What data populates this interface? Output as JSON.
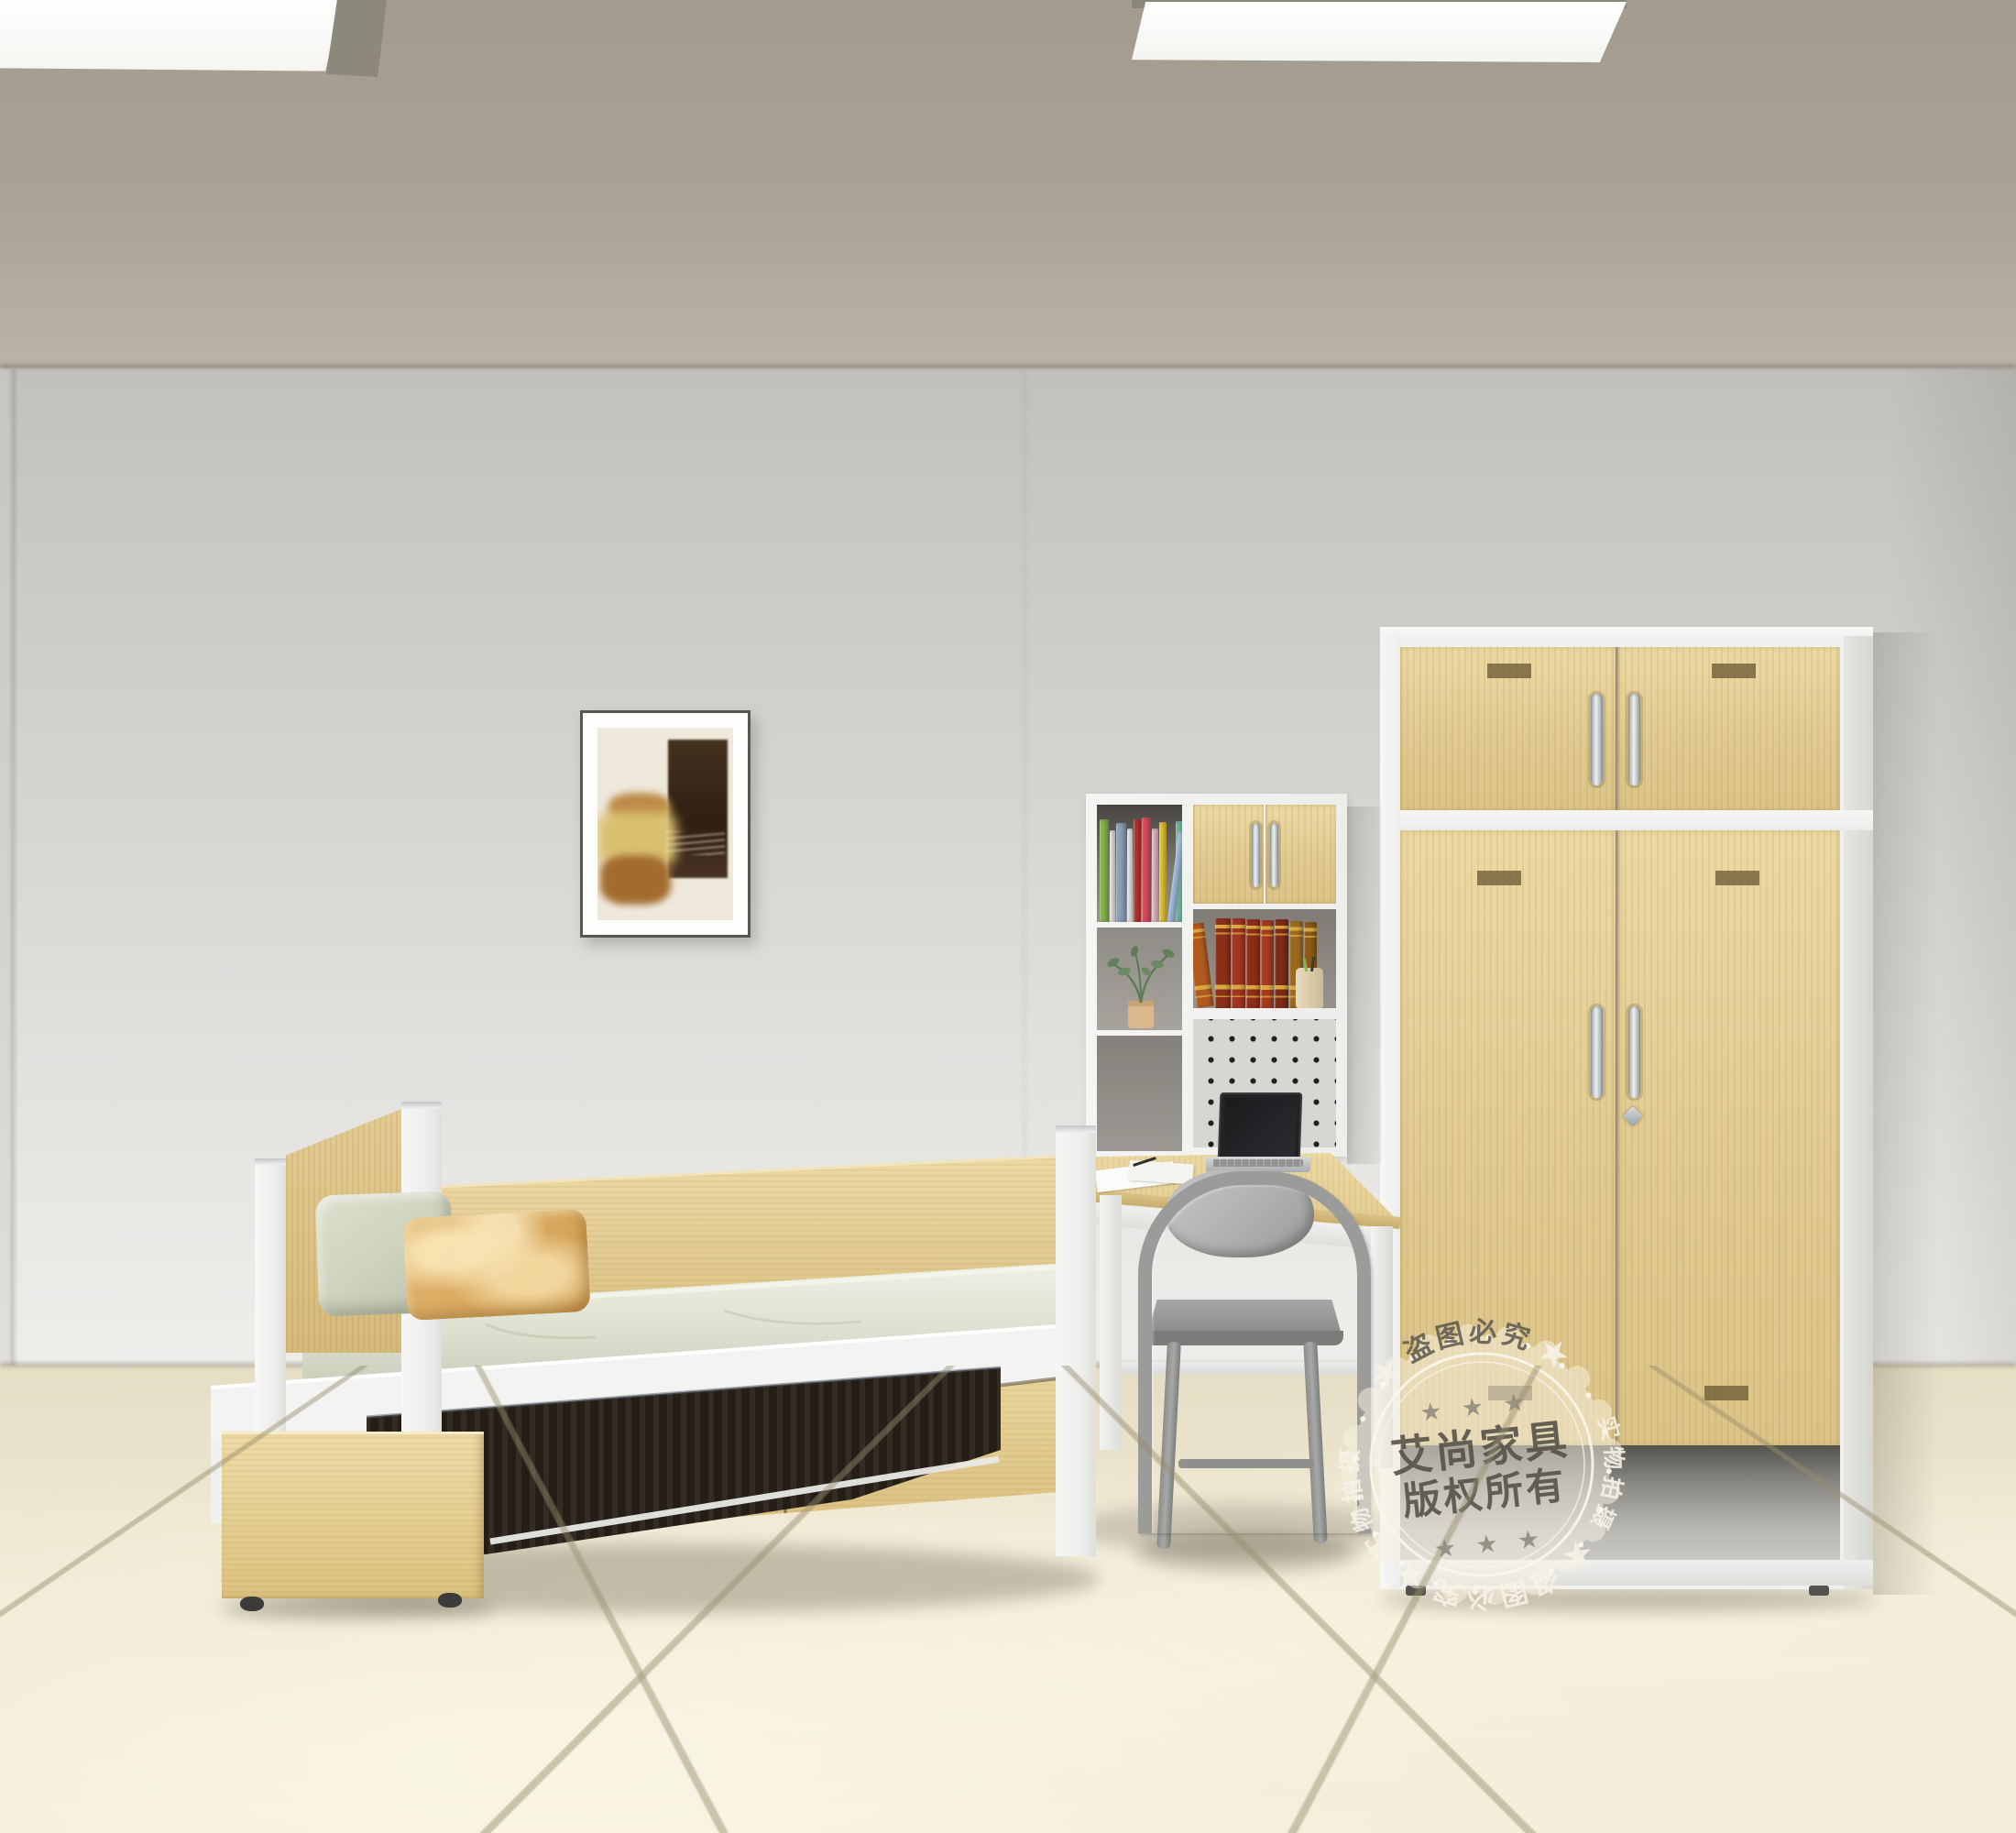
{
  "watermark": {
    "center_line1": "艾尚家具",
    "center_line2": "版权所有",
    "stars_row": "★ ★ ★",
    "star_pair": "★ ★",
    "top_text": "盗图必究",
    "bottom_text": "盗图必究",
    "side_text": "实物拍摄"
  },
  "palette": {
    "wood_light": "#ecd9a2",
    "wood_mid": "#dcc487",
    "frame_white": "#f4f4f2",
    "wall": "#d6d5d2",
    "ceiling": "#a9a194",
    "floor_tile": "#efe8d2",
    "floor_grout": "#b9b096",
    "mattress_sage": "#dde1d0",
    "pillow_green": "#ccd2bc",
    "pillow_tan": "#ddb06a",
    "chair_gray": "#9b9b99",
    "trundle_slats": "#241e17",
    "stamp_ink": "#514e47",
    "stamp_cream": "#f6f1e3"
  },
  "books": {
    "colorful": [
      {
        "color": "#86b34c",
        "w": 14,
        "h": 112
      },
      {
        "color": "#ecebe6",
        "w": 8,
        "h": 100
      },
      {
        "color": "#8da0b8",
        "w": 15,
        "h": 108
      },
      {
        "color": "#f3f1ed",
        "w": 8,
        "h": 102
      },
      {
        "color": "#b8352f",
        "w": 11,
        "h": 112
      },
      {
        "color": "#d84a5e",
        "w": 14,
        "h": 114
      },
      {
        "color": "#eab9c6",
        "w": 9,
        "h": 102
      },
      {
        "color": "#e5c335",
        "w": 12,
        "h": 109
      },
      {
        "color": "#9db9d9",
        "w": 11,
        "h": 99,
        "tilt": 7
      },
      {
        "color": "#6fae9b",
        "w": 13,
        "h": 110
      }
    ],
    "classics": [
      {
        "color": "#b05a20",
        "w": 19,
        "h": 92,
        "tilt": -7
      },
      {
        "color": "#8a2f1a",
        "w": 17,
        "h": 98
      },
      {
        "color": "#a03522",
        "w": 15,
        "h": 98
      },
      {
        "color": "#8f2d18",
        "w": 15,
        "h": 97
      },
      {
        "color": "#a43a20",
        "w": 14,
        "h": 96
      },
      {
        "color": "#7d2a16",
        "w": 15,
        "h": 97
      },
      {
        "color": "#9c6a1e",
        "w": 15,
        "h": 95
      },
      {
        "color": "#8a5a16",
        "w": 14,
        "h": 94
      }
    ]
  }
}
